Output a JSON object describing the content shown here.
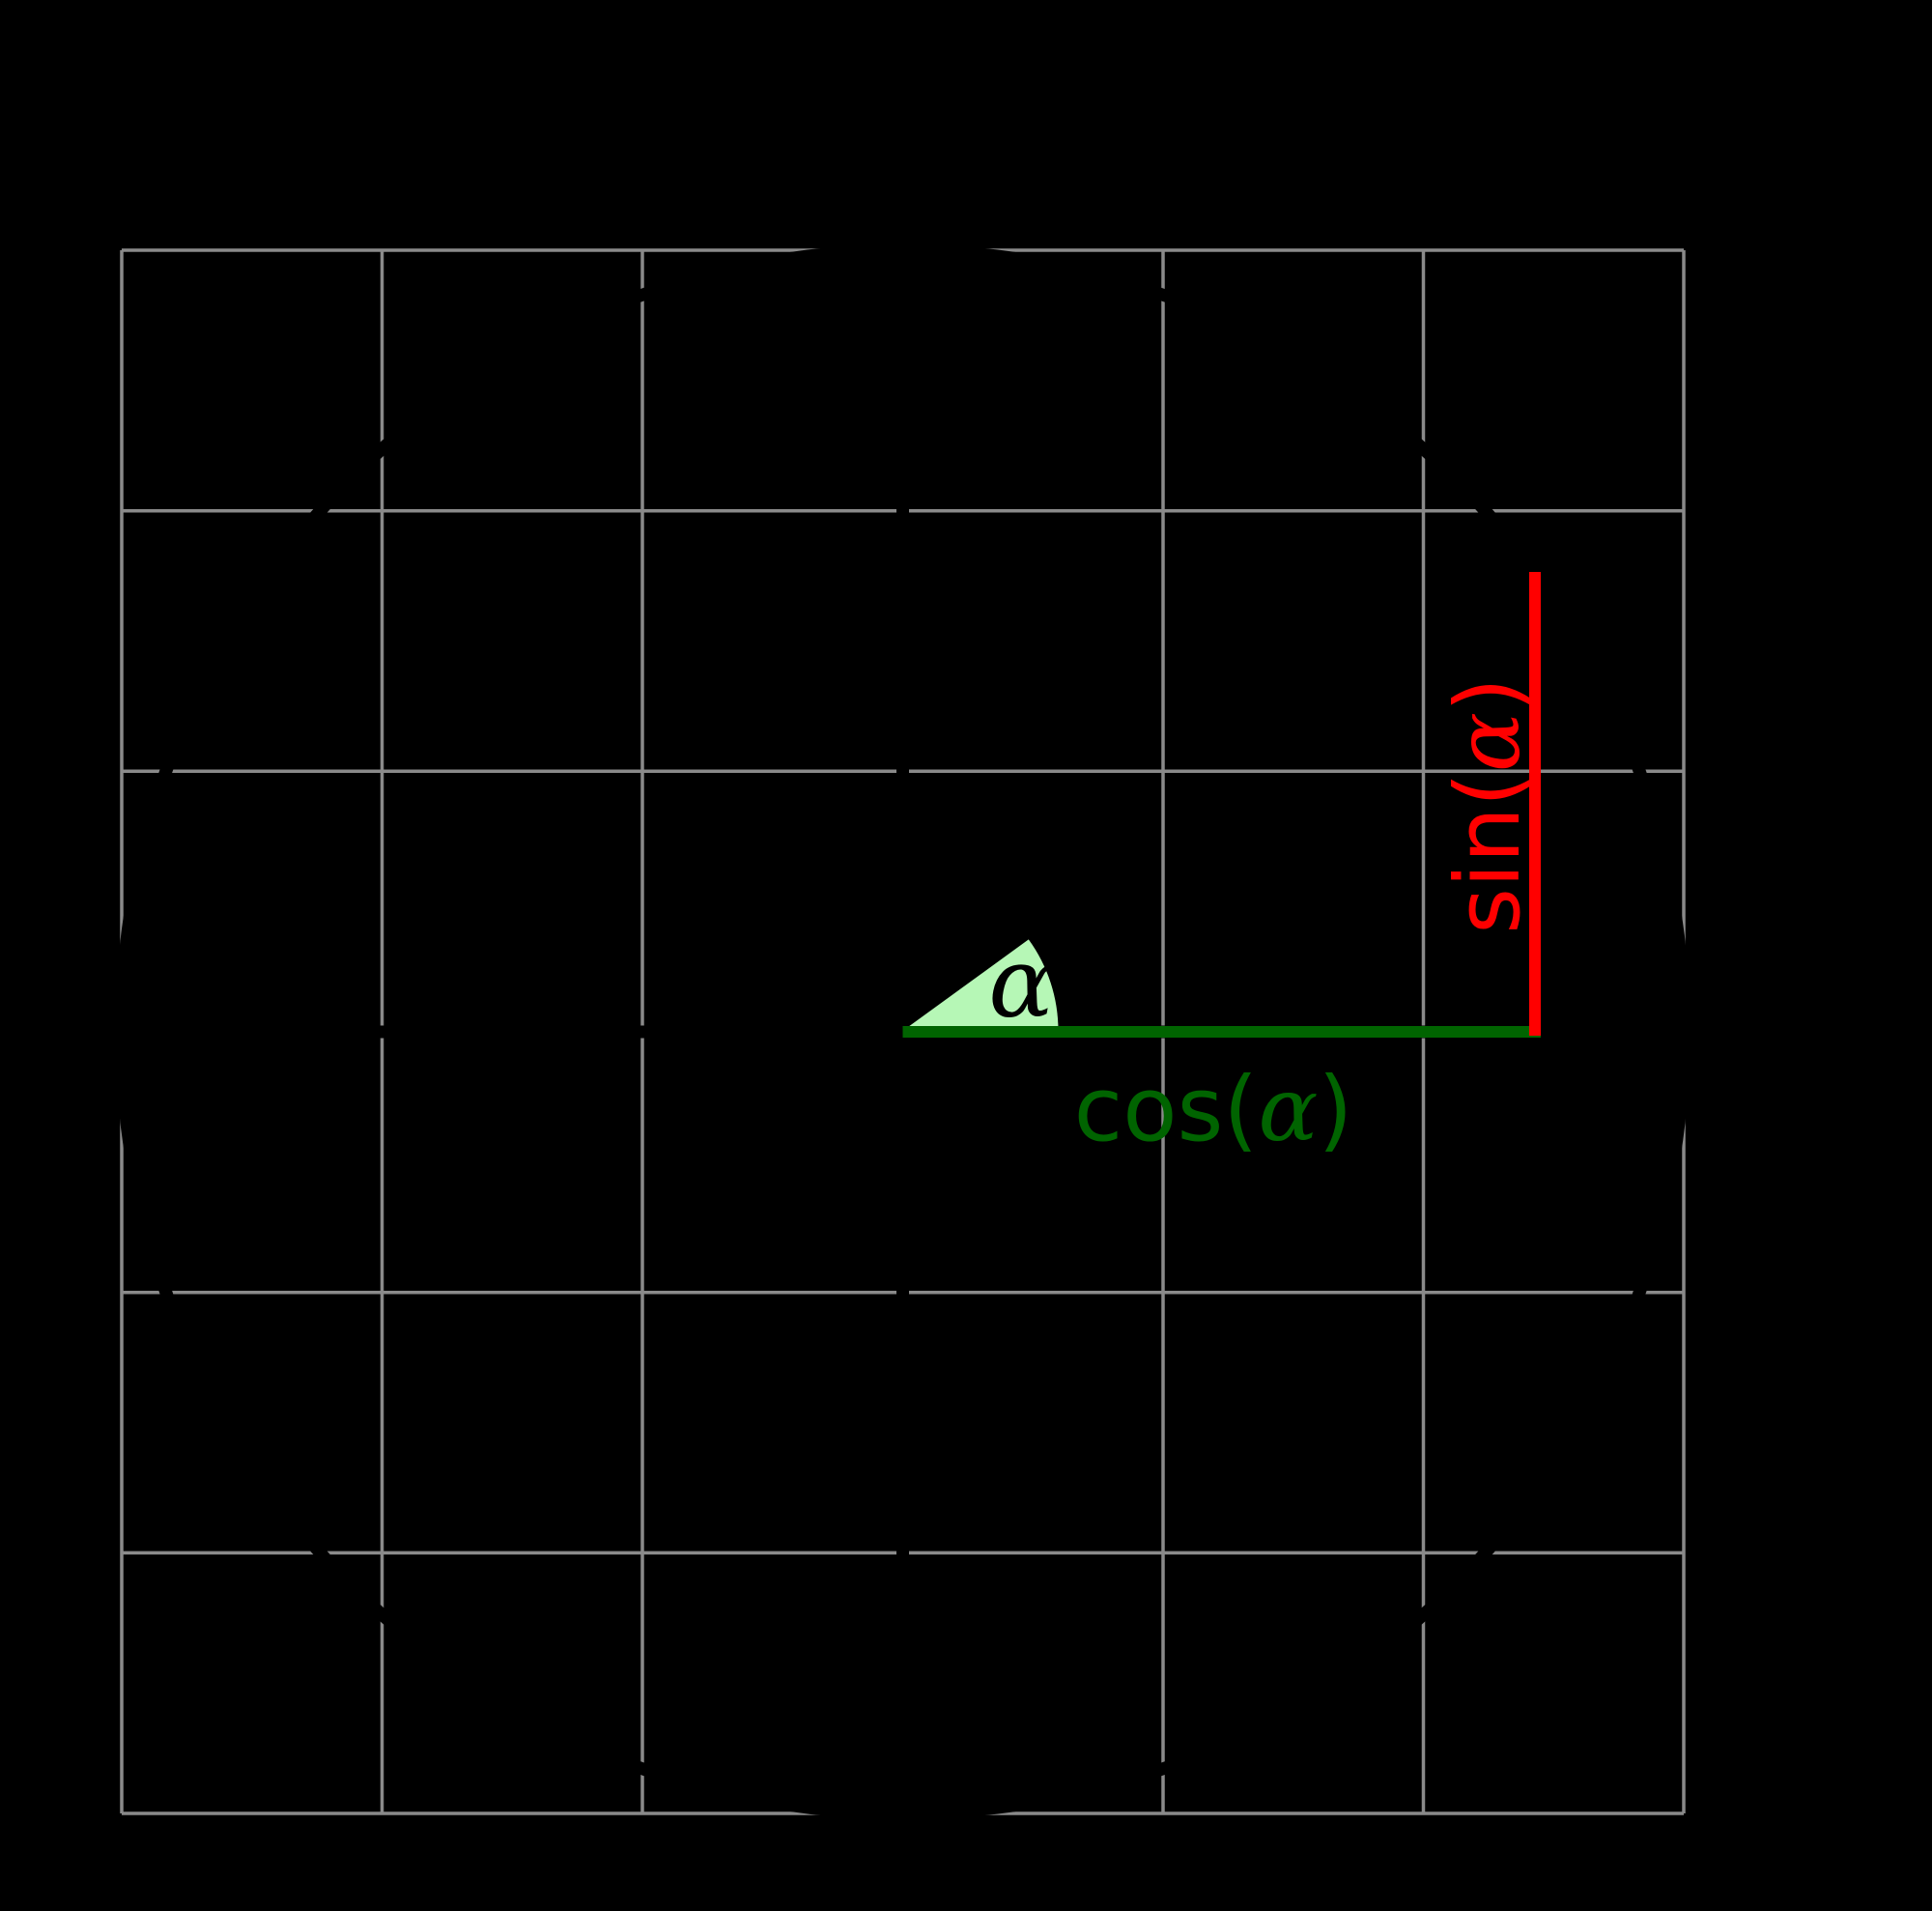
{
  "figure": {
    "alpha_label": "α",
    "cos_label": {
      "prefix": "cos(",
      "alpha": "α",
      "suffix": ")"
    },
    "sin_label": {
      "prefix": "sin(",
      "alpha": "α",
      "suffix": ")"
    }
  },
  "colors": {
    "background": "#000000",
    "grid_gray": "#8a8a8a",
    "cos_green": "#006400",
    "sin_red": "#ff0000",
    "wedge_fill": "#b6f7b6",
    "ink_black": "#000000"
  },
  "chart_data": {
    "type": "line",
    "title": "",
    "xlabel": "",
    "ylabel": "",
    "xlim": [
      -1,
      1
    ],
    "ylim": [
      -1,
      1
    ],
    "grid": {
      "on": true,
      "step": 0.333,
      "x_lines": [
        -1,
        -0.667,
        -0.333,
        0,
        0.333,
        0.667,
        1
      ],
      "y_lines": [
        -1,
        -0.667,
        -0.333,
        0,
        0.333,
        0.667,
        1
      ]
    },
    "axes_through_origin": true,
    "unit_circle": {
      "cx": 0,
      "cy": 0,
      "r": 1
    },
    "alpha_deg": 36,
    "point_on_circle": {
      "x": 0.809,
      "y": 0.588
    },
    "series": [
      {
        "name": "cos segment",
        "x": [
          0,
          0.809
        ],
        "y": [
          0,
          0
        ],
        "color": "#006400",
        "label": "cos(α)"
      },
      {
        "name": "sin segment",
        "x": [
          0.809,
          0.809
        ],
        "y": [
          0,
          0.588
        ],
        "color": "#ff0000",
        "label": "sin(α)"
      }
    ],
    "angle_wedge": {
      "r": 0.2,
      "from_deg": 0,
      "to_deg": 36,
      "label": "α"
    },
    "legend": "none"
  }
}
